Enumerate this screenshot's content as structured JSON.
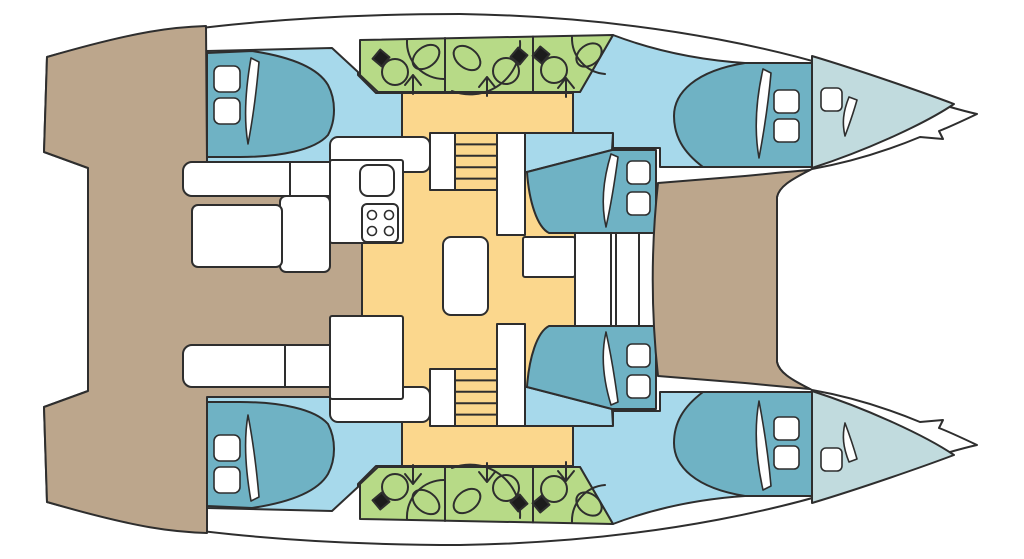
{
  "diagram": {
    "type": "catamaran-deck-plan",
    "view": "top-down floor plan",
    "orientation": "bow-right, stern-left",
    "hulls": [
      "port (top)",
      "starboard (bottom)"
    ]
  },
  "palette": {
    "background": "#ffffff",
    "hull_white": "#ffffff",
    "deck_wood": "#bca68c",
    "cabin_floor": "#a7d9eb",
    "bed": "#6fb2c4",
    "forepeak": "#c1dbde",
    "bathroom": "#b7da87",
    "salon_floor": "#fbd78d",
    "furniture": "#ffffff",
    "outline": "#2e2e2e",
    "fixture_dark": "#1c1c1c"
  },
  "rooms": {
    "salon": {
      "floor": "salon_floor",
      "items": [
        "galley-counter",
        "galley-sink",
        "stove-4-burner",
        "salon-table",
        "nav-desk",
        "staircase-port",
        "staircase-starboard"
      ]
    },
    "cockpit": {
      "floor": "deck_wood",
      "items": [
        "bench-seat-port",
        "bench-seat-starboard",
        "l-bench",
        "cockpit-table"
      ]
    },
    "foredeck": {
      "floor": "deck_wood"
    },
    "cabins": [
      {
        "id": "aft-cabin-port",
        "items": [
          "double-bed",
          "pillow",
          "pillow"
        ]
      },
      {
        "id": "mid-cabin-port",
        "items": [
          "double-bed",
          "pillow",
          "pillow"
        ]
      },
      {
        "id": "forward-cabin-port",
        "items": [
          "double-bed",
          "pillow",
          "pillow"
        ]
      },
      {
        "id": "aft-cabin-starboard",
        "items": [
          "double-bed",
          "pillow",
          "pillow"
        ]
      },
      {
        "id": "mid-cabin-starboard",
        "items": [
          "double-bed",
          "pillow",
          "pillow"
        ]
      },
      {
        "id": "forward-cabin-starboard",
        "items": [
          "double-bed",
          "pillow",
          "pillow"
        ]
      }
    ],
    "bathrooms": {
      "port_compartments": 3,
      "starboard_compartments": 3,
      "fixtures_per_compartment": [
        "toilet",
        "sink-oval",
        "shower-arrow",
        "shower-curve"
      ]
    },
    "forepeaks": [
      {
        "id": "forepeak-port",
        "items": [
          "hatch"
        ]
      },
      {
        "id": "forepeak-starboard",
        "items": [
          "hatch"
        ]
      }
    ]
  },
  "icons": {
    "toilet": "circle-with-dark-tank",
    "sink": "rotated-oval",
    "shower": "arrow-glyph",
    "stove": "four-burner-circles",
    "stairs": "tread-lines",
    "pillow": "rounded-square",
    "bedding-fold": "white-crescent"
  },
  "counts": {
    "cabins": 6,
    "double_beds": 6,
    "bathroom_compartments": 6,
    "staircases": 2,
    "forepeak_hatches": 2
  }
}
